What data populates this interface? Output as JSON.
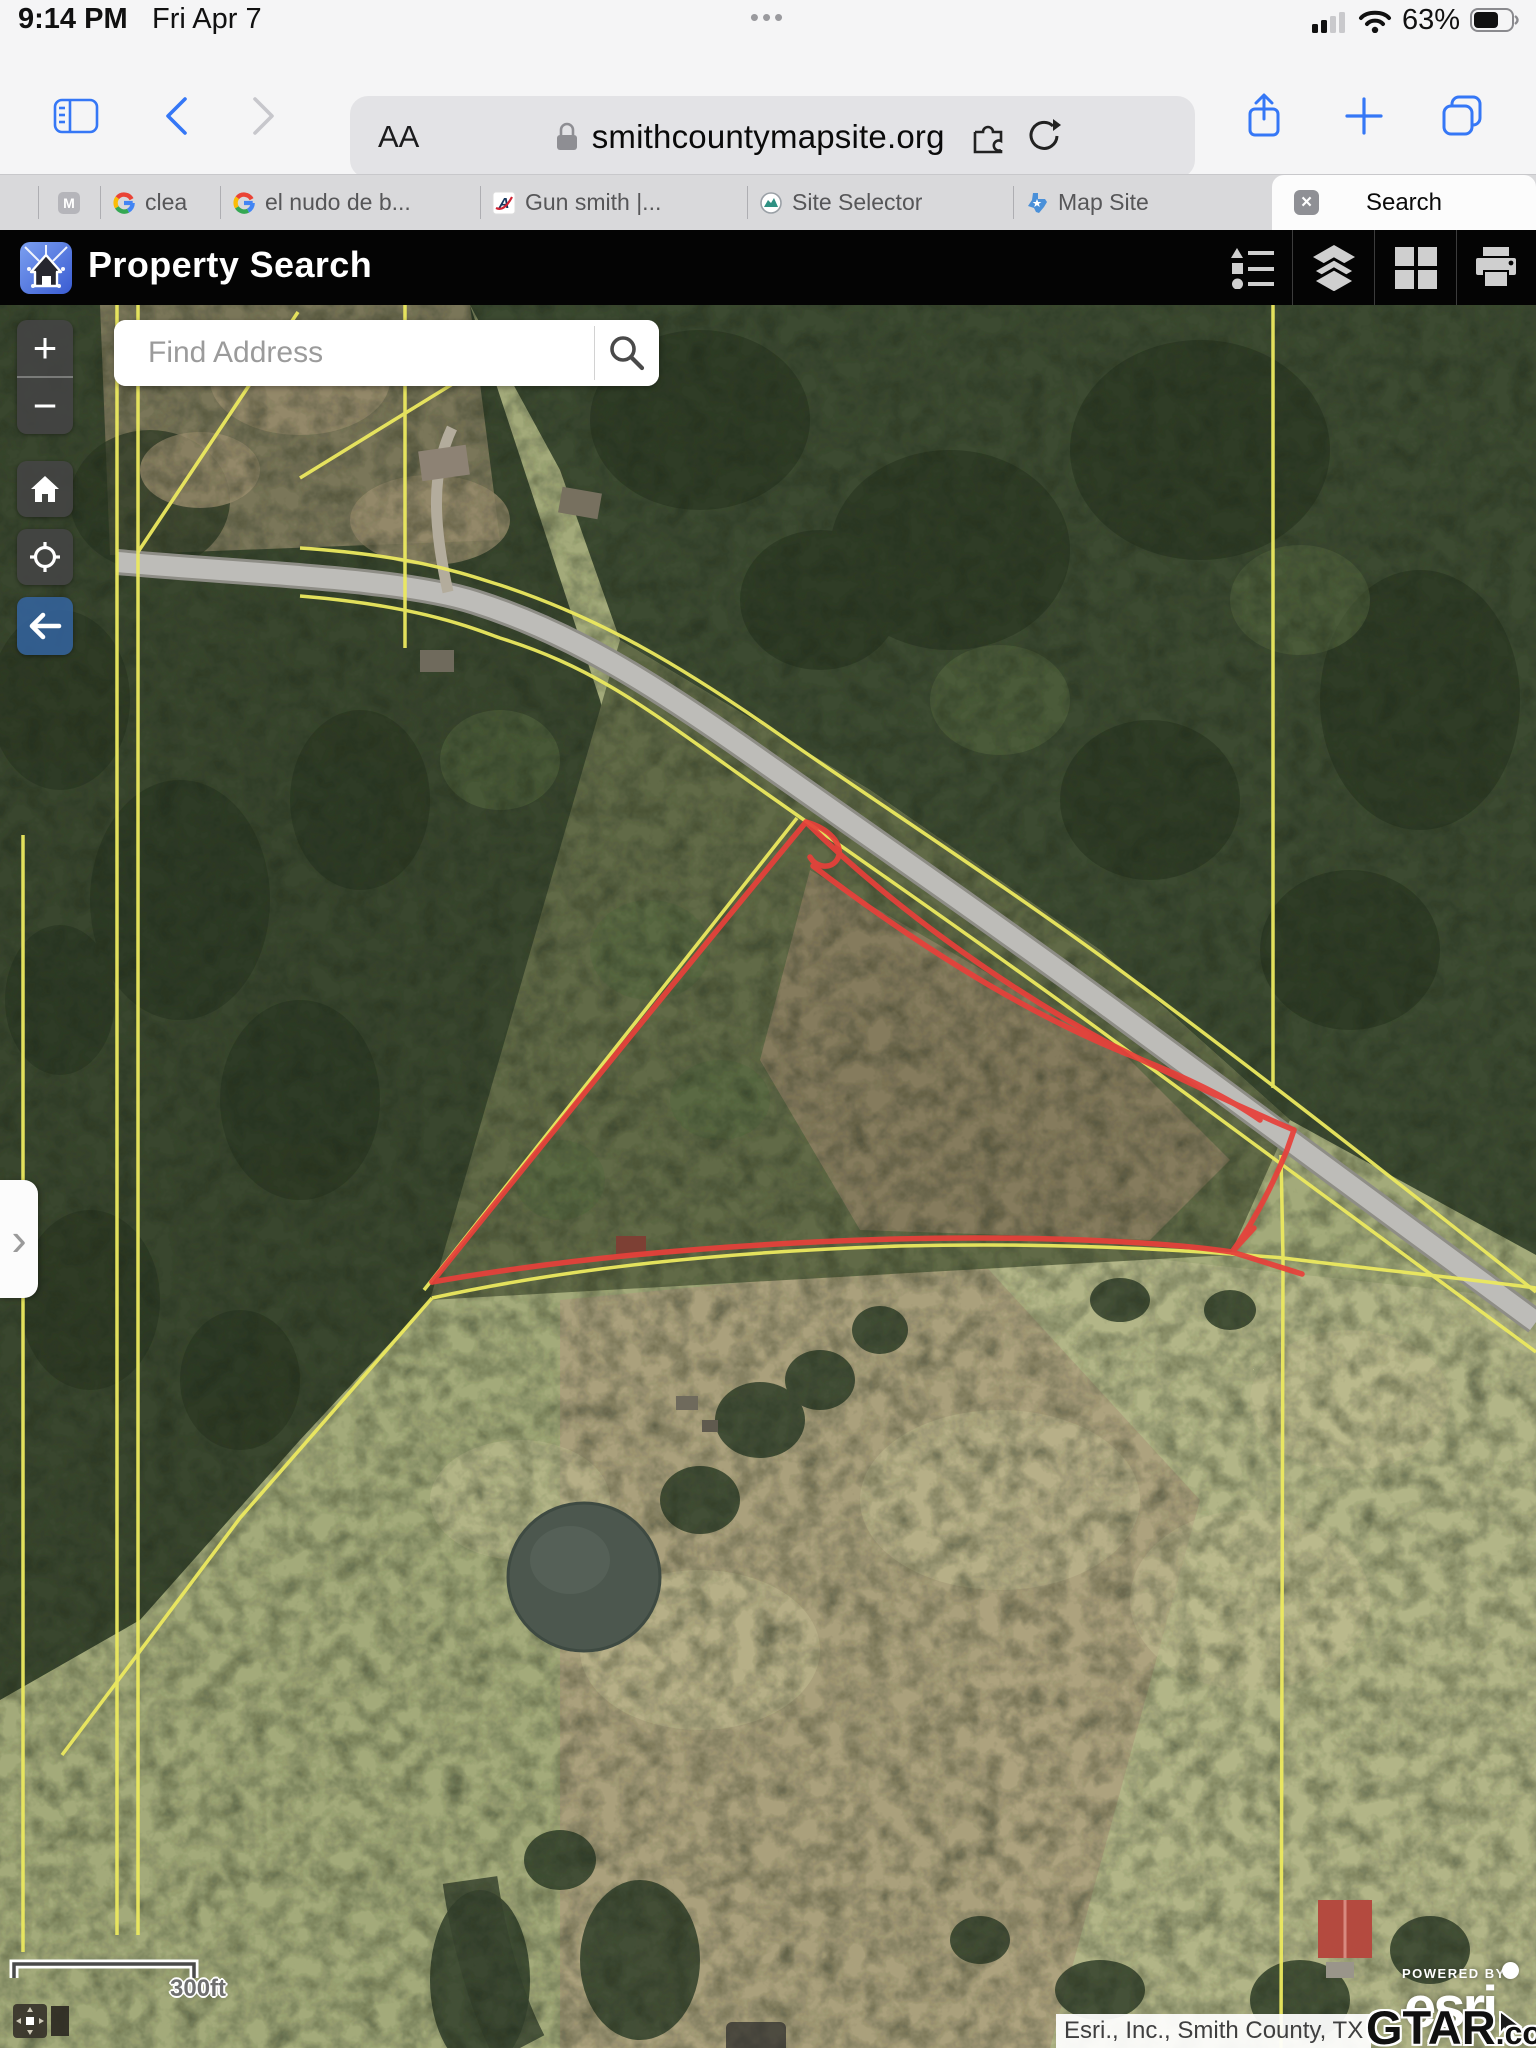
{
  "status_bar": {
    "time": "9:14 PM",
    "date": "Fri Apr 7",
    "battery_percent": "63%"
  },
  "toolbar": {
    "reader_label": "AA",
    "url": "smithcountymapsite.org"
  },
  "tab_bar": {
    "tabs": [
      {
        "favicon_text": "M",
        "title": ""
      },
      {
        "title": "clea"
      },
      {
        "title": "el nudo de b..."
      },
      {
        "title": "Gun smith |..."
      },
      {
        "title": "Site Selector"
      },
      {
        "title": "Map Site"
      },
      {
        "title": "Search",
        "active": true
      }
    ]
  },
  "app_header": {
    "title": "Property Search"
  },
  "search": {
    "placeholder": "Find Address"
  },
  "icons": {
    "zoom_in": "+",
    "zoom_out": "−",
    "panel_expand": "›",
    "tab_close": "×",
    "page_dots": "•••"
  },
  "map_ui": {
    "scale_label": "300ft",
    "attribution": "Esri., Inc., Smith County, TX",
    "powered_by": "POWERED BY",
    "esri_wordmark": "esri",
    "watermark_main": "GTAR",
    "watermark_suffix": ".com"
  },
  "colors": {
    "selection_red": "#e8403a",
    "parcel_yellow": "#ece95f",
    "road_gray": "#bdbcb8",
    "accent_blue": "#3577f6"
  }
}
